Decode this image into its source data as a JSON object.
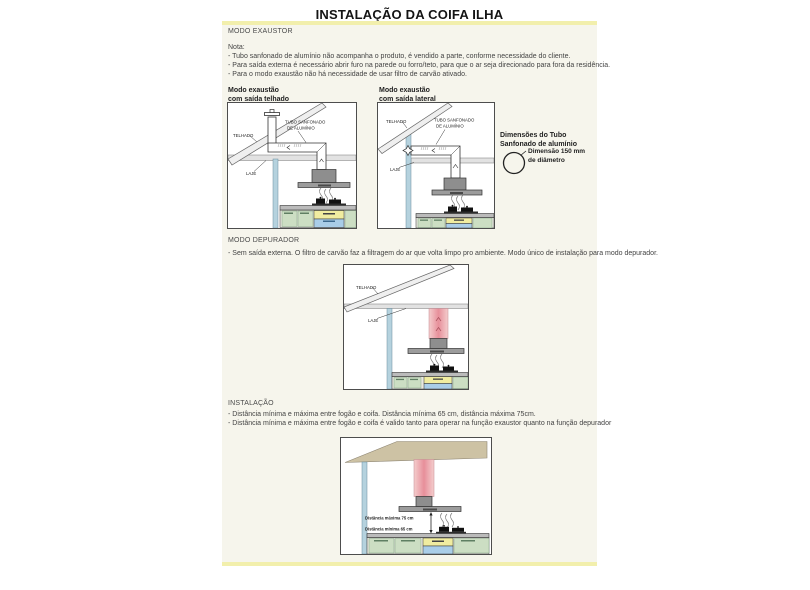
{
  "page": {
    "title": "INSTALAÇÃO DA COIFA ILHA"
  },
  "colors": {
    "accent_yellow": "#f2efac",
    "content_bg": "#f6f5ec",
    "wall_blue": "#b5d2de",
    "hood_gray": "#9c9c9c",
    "chimney_gray": "#8e8e8e",
    "pink_duct_center": "#e78f9a",
    "pink_duct_edge": "#f4cdcd",
    "cabinet_green": "#ccdec3",
    "drawer_yellow": "#f0eca0",
    "oven_blue": "#a9cde8",
    "ceiling_tan": "#cdc2a4"
  },
  "exaustor": {
    "heading": "MODO EXAUSTOR",
    "nota_label": "Nota:",
    "notes": [
      "- Tubo sanfonado de alumínio não acompanha o produto, é vendido a parte, conforme necessidade do cliente.",
      "- Para saída externa é necessário abrir furo na parede ou forro/teto, para que o ar seja direcionado para fora da residência.",
      "- Para o modo exaustão não há necessidade de usar filtro de carvão ativado."
    ],
    "diagram_roof": {
      "title1": "Modo exaustão",
      "title2": "com saída telhado"
    },
    "diagram_side": {
      "title1": "Modo exaustão",
      "title2": "com saída lateral"
    },
    "labels": {
      "telhado": "TELHADO",
      "laje": "LAJE",
      "tubo1": "TUBO SANFONADO",
      "tubo2": "DE ALUMÍNIO"
    },
    "tube_dim": {
      "title1": "Dimensões do Tubo",
      "title2": "Sanfonado de alumínio",
      "dim1": "Dimensão 150 mm",
      "dim2": "de diâmetro"
    }
  },
  "depurador": {
    "heading": "MODO DEPURADOR",
    "note": "- Sem saída externa. O filtro de carvão faz a filtragem do ar que volta limpo pro ambiente. Modo único de instalação para modo depurador.",
    "labels": {
      "telhado": "TELHADO",
      "laje": "LAJE"
    }
  },
  "instalacao": {
    "heading": "INSTALAÇÃO",
    "notes": [
      "- Distância mínima e máxima entre fogão e coifa. Distância mínima 65 cm, distância máxima 75cm.",
      "- Distância mínima e máxima entre fogão e coifa é valido tanto para operar na função exaustor quanto na função depurador"
    ],
    "labels": {
      "dist_max": "Distância máxima 75 cm",
      "dist_min": "Distância mínima 65 cm"
    }
  }
}
